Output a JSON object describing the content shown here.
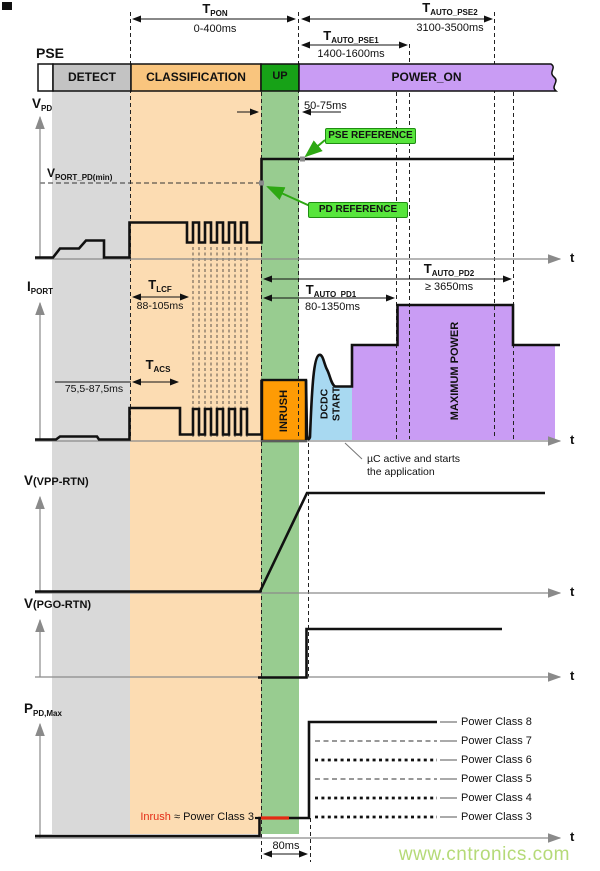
{
  "pse_bar": {
    "label": "PSE",
    "segments": {
      "detect": "DETECT",
      "classification": "CLASSIFICATION",
      "up": "UP",
      "power_on": "POWER_ON"
    }
  },
  "timing": {
    "t_pon": {
      "sym": "T",
      "sub": "PON",
      "range": "0-400ms"
    },
    "t_auto_pse1": {
      "sym": "T",
      "sub": "AUTO_PSE1",
      "range": "1400-1600ms"
    },
    "t_auto_pse2": {
      "sym": "T",
      "sub": "AUTO_PSE2",
      "range": "3100-3500ms"
    },
    "t_up": {
      "range": "50-75ms"
    },
    "t_lcf": {
      "sym": "T",
      "sub": "LCF",
      "range": "88-105ms"
    },
    "t_acs": {
      "sym": "T",
      "sub": "ACS",
      "range": "75,5-87,5ms"
    },
    "t_auto_pd1": {
      "sym": "T",
      "sub": "AUTO_PD1",
      "range": "80-1350ms"
    },
    "t_auto_pd2": {
      "sym": "T",
      "sub": "AUTO_PD2",
      "range": "≥ 3650ms"
    },
    "t_inrush": {
      "range": "80ms"
    }
  },
  "signals": {
    "vpd": {
      "sym": "V",
      "sub": "PD"
    },
    "iport": {
      "sym": "I",
      "sub": "PORT"
    },
    "vvpp": {
      "sym": "V",
      "sub": "(VPP-RTN)"
    },
    "vpgo": {
      "sym": "V",
      "sub": "(PGO-RTN)"
    },
    "ppdmax": {
      "sym": "P",
      "sub": "PD,Max"
    },
    "vport_pd_min": {
      "sym": "V",
      "sub": "PORT_PD(min)"
    },
    "t_axis": "t"
  },
  "annotations": {
    "pse_reference": "PSE REFERENCE",
    "pd_reference": "PD REFERENCE",
    "inrush_box": "INRUSH",
    "dcdc_line1": "DCDC",
    "dcdc_line2": "START",
    "maximum_power": "MAXIMUM POWER",
    "uc_line1": "µC active and starts",
    "uc_line2": "the application",
    "inrush_note_red": "Inrush",
    "inrush_note_rest": " ≈ Power Class 3"
  },
  "power_classes": [
    "Power Class 8",
    "Power Class 7",
    "Power Class 6",
    "Power Class 5",
    "Power Class 4",
    "Power Class 3"
  ],
  "watermark": "www.cntronics.com",
  "colors": {
    "band_gray": "#d9d9d9",
    "band_orange": "#fcdcb2",
    "band_green": "#98cc90",
    "seg_detect": "#c3c3c3",
    "seg_classification": "#f9c57e",
    "seg_up": "#17a217",
    "seg_power_on": "#c99cf4",
    "inrush_orange": "#fe9b05",
    "dcdc_blue": "#a8d9f1",
    "max_power_purple": "#c99cf4",
    "reference_green": "#57e53c",
    "reference_border": "#1f8d12",
    "inrush_red": "#e42b14",
    "watermark_green": "#b5da78"
  }
}
